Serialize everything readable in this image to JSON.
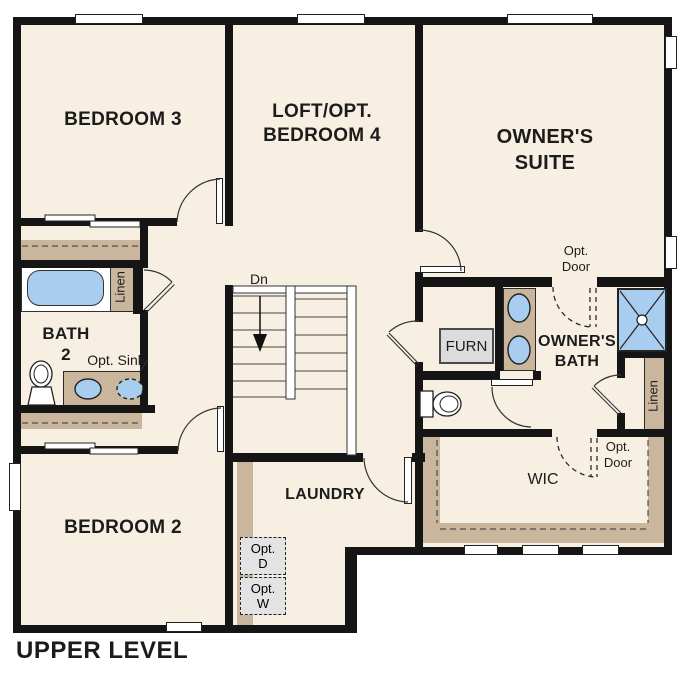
{
  "title": "UPPER LEVEL",
  "colors": {
    "wall": "#141414",
    "floor": "#f7efe2",
    "millwork_tan": "#c9b69d",
    "fixture_blue": "#a9cdee",
    "appliance_gray": "#e3e3e3",
    "furnace_gray": "#dcdcdc",
    "text": "#1c1c1c"
  },
  "rooms": {
    "bedroom3": "BEDROOM 3",
    "loft_line1": "LOFT/OPT.",
    "loft_line2": "BEDROOM 4",
    "owners_suite_line1": "OWNER'S",
    "owners_suite_line2": "SUITE",
    "bath2_line1": "BATH",
    "bath2_line2": "2",
    "owners_bath_line1": "OWNER'S",
    "owners_bath_line2": "BATH",
    "laundry": "LAUNDRY",
    "bedroom2": "BEDROOM 2",
    "wic": "WIC"
  },
  "labels": {
    "linen_bath2": "Linen",
    "linen_owners": "Linen",
    "opt_sink": "Opt. Sink",
    "furnace": "FURN",
    "stairs_down": "Dn",
    "opt_door_suite_line1": "Opt.",
    "opt_door_suite_line2": "Door",
    "opt_door_wic_line1": "Opt.",
    "opt_door_wic_line2": "Door",
    "opt_dryer_line1": "Opt.",
    "opt_dryer_line2": "D",
    "opt_washer_line1": "Opt.",
    "opt_washer_line2": "W"
  }
}
